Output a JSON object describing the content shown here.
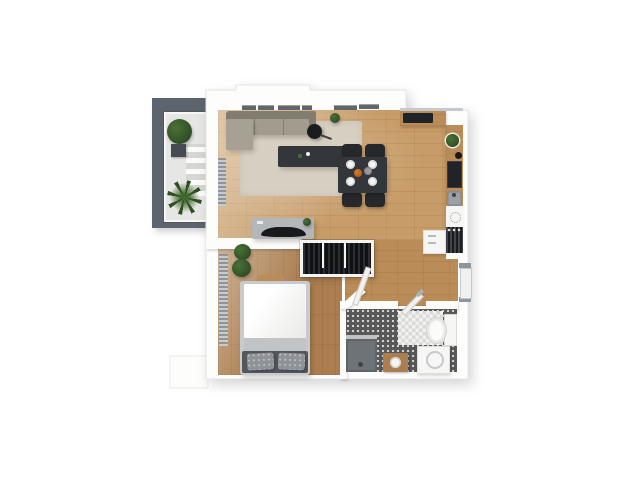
{
  "scene": {
    "title": "apartment-floor-plan-3d-render",
    "view": "top-down",
    "style": "photorealistic-3d-floor-plan",
    "icons": {
      "vent_fan_icon": "dotted-circle",
      "plant_icon": "green-circle",
      "palm_icon": "spiked-green-circle"
    },
    "palette": {
      "wall": "#fcfcfb",
      "balcony_slab": "#5c656e",
      "deck": "#e6e6e4",
      "wood_light": "#c79c68",
      "wood_mid": "#ba8c57",
      "wood_dark": "#ab7d4f",
      "rug": "#d7d0c2",
      "sofa_base": "#a29c8f",
      "sofa_back": "#827d6f",
      "sofa_chaise": "#a7a194",
      "charcoal": "#33363a",
      "chair_dark": "#26282c",
      "silver": "#b4b7b9",
      "steel": "#9ba1a6",
      "tile_dark": "#585858",
      "checker_a": "#d9d9d7",
      "checker_b": "#f1f1ef",
      "shower": "#6e7377",
      "white_goods": "#f6f6f4",
      "bed_frame": "#c8cacc",
      "blanket": "#c1c4c7",
      "headboard": "#54585d",
      "pillow": "#8e9398",
      "radiator_a": "#c6cbcf",
      "radiator_b": "#8e9499",
      "green_dark": "#2f4e26",
      "green_mid": "#4a7136",
      "wine_dark": "#1a1b1f",
      "stove_dark": "#202327",
      "accent_food": "#d97a2a"
    },
    "rooms": [
      {
        "name": "balcony",
        "items": [
          "concrete-slab",
          "wood-deck",
          "railing",
          "round-bush-plant",
          "planter-box",
          "palm-plant",
          "striped-lounger"
        ]
      },
      {
        "name": "living-room",
        "items": [
          "window-band",
          "corner-sofa",
          "area-rug",
          "coffee-table",
          "floor-lamp",
          "radiator",
          "tv-console",
          "tv",
          "floor-plant"
        ]
      },
      {
        "name": "dining-area",
        "items": [
          "dining-table",
          "chair",
          "chair",
          "chair",
          "chair",
          "plates",
          "food-bowl",
          "serving-bowl"
        ]
      },
      {
        "name": "kitchen",
        "items": [
          "top-counter",
          "cooktop",
          "counter-column",
          "fruit-bowl",
          "pot",
          "oven",
          "sink",
          "vent-cabinet",
          "wine-rack",
          "base-cabinet"
        ]
      },
      {
        "name": "hallway",
        "items": [
          "open-wardrobe",
          "entry-door",
          "bedroom-door"
        ]
      },
      {
        "name": "bedroom",
        "items": [
          "double-bed",
          "duvet",
          "blanket",
          "pillows",
          "headboard-bench",
          "radiator",
          "bush-plants",
          "wood-tray"
        ]
      },
      {
        "name": "bathroom",
        "items": [
          "mosaic-floor",
          "checker-rug",
          "shower",
          "sink-vanity",
          "toilet",
          "washing-machine",
          "door"
        ]
      }
    ]
  }
}
